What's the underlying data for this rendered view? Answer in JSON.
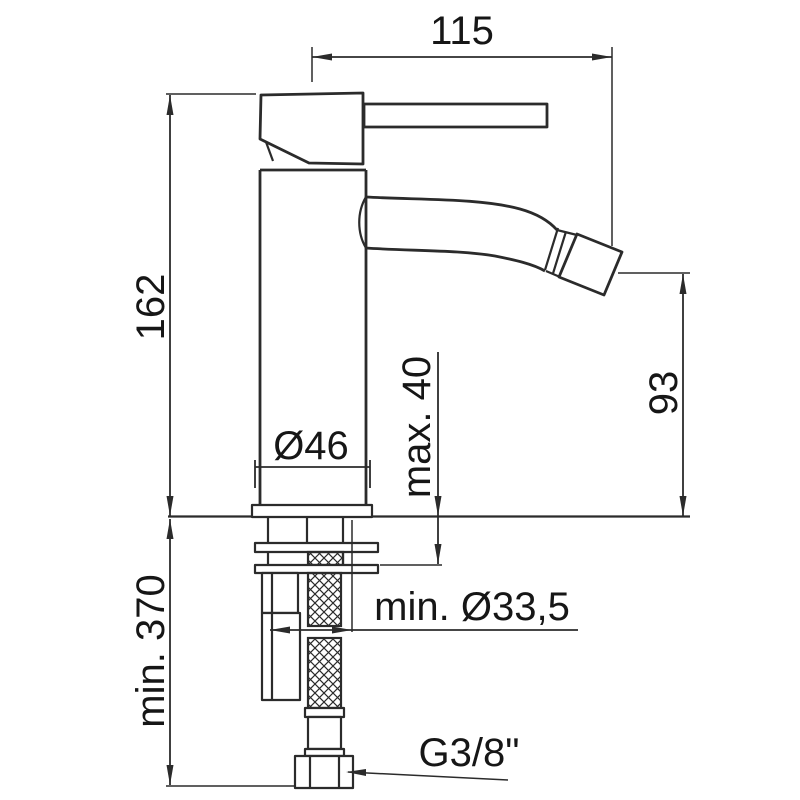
{
  "page": {
    "background": "#ffffff",
    "line_color": "#2b2b2b",
    "text_color": "#161616"
  },
  "drawing": {
    "type": "technical-dimension-drawing",
    "subject": "single-lever mixer tap, side elevation with installation dimensions",
    "units": "mm",
    "labels": {
      "spout_reach": "115",
      "total_height": "162",
      "spout_height": "93",
      "deck_max": "max. 40",
      "base_dia": "Ø46",
      "hose_min": "min. 370",
      "hole_min": "min. Ø33,5",
      "thread": "G3/8\""
    }
  }
}
